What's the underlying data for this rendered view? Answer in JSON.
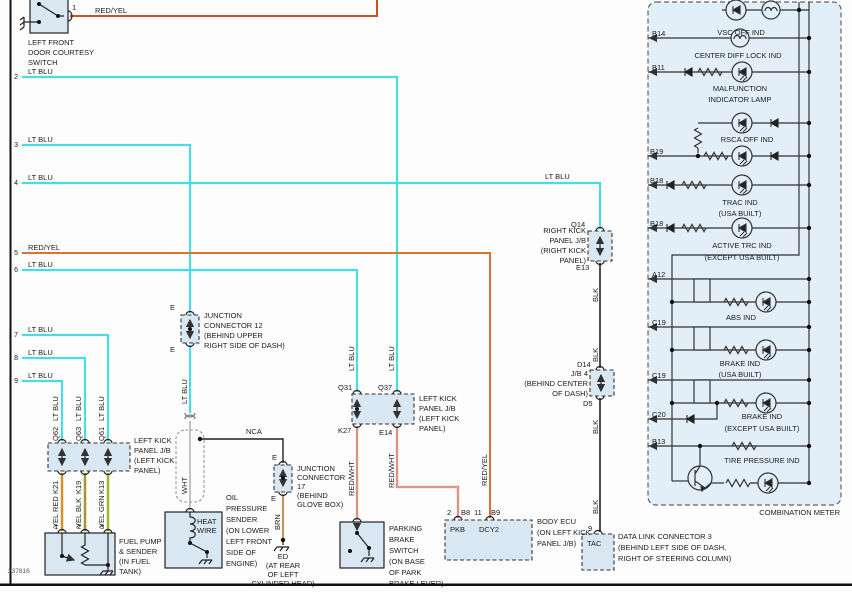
{
  "figure_number": "237816",
  "wire_colors": {
    "lt_blu": "#4ADCE6",
    "red_yel": "#D4512E",
    "red_wht": "#CC5544",
    "yel": "#E4D35C",
    "brn": "#C19A5B",
    "blk": "#3A3A3A",
    "wht": "#C3C3C3"
  },
  "courtesy_switch": {
    "pin": "1",
    "wire_label": "RED/YEL",
    "name_lines": [
      "LEFT FRONT",
      "DOOR COURTESY",
      "SWITCH"
    ]
  },
  "left_lines": [
    {
      "n": "2",
      "label": "LT BLU"
    },
    {
      "n": "3",
      "label": "LT BLU"
    },
    {
      "n": "4",
      "label": "LT BLU",
      "label2": "LT BLU"
    },
    {
      "n": "5",
      "label": "RED/YEL"
    },
    {
      "n": "6",
      "label": "LT BLU"
    },
    {
      "n": "7",
      "label": "LT BLU"
    },
    {
      "n": "8",
      "label": "LT BLU"
    },
    {
      "n": "9",
      "label": "LT BLU"
    }
  ],
  "jb_left_1": {
    "top_pins": [
      "Q62",
      "Q63",
      "Q61"
    ],
    "top_wires": [
      "LT BLU",
      "LT BLU",
      "LT BLU"
    ],
    "bottom_pins": [
      "K21",
      "K19",
      "K13"
    ],
    "bottom_wires": [
      "YEL RED",
      "YEL BLK",
      "YEL GRN"
    ],
    "name_lines": [
      "LEFT KICK",
      "PANEL J/B",
      "(LEFT KICK",
      "PANEL)"
    ]
  },
  "fuel_pump": {
    "pins": [
      "1",
      "2",
      "3"
    ],
    "name_lines": [
      "FUEL PUMP",
      "& SENDER",
      "(IN FUEL",
      "TANK)"
    ]
  },
  "jc12": {
    "pin_top": "E",
    "pin_bottom": "E",
    "wire_below": "LT BLU",
    "name_lines": [
      "JUNCTION",
      "CONNECTOR 12",
      "(BEHIND UPPER",
      "RIGHT SIDE OF DASH)"
    ]
  },
  "shield": {
    "wire": "WHT",
    "nca": "NCA"
  },
  "oil_sender": {
    "inner_lines": [
      "HEAT",
      "WIRE"
    ],
    "name_lines": [
      "OIL",
      "PRESSURE",
      "SENDER",
      "(ON LOWER",
      "LEFT FRONT",
      "SIDE OF",
      "ENGINE)"
    ]
  },
  "jc17": {
    "pin_top": "E",
    "pin_bottom": "E",
    "wire_below": "BRN",
    "name_lines": [
      "JUNCTION",
      "CONNECTOR",
      "17",
      "(BEHIND",
      "GLOVE BOX)"
    ],
    "ground_lines": [
      "ED",
      "(AT REAR",
      "OF LEFT",
      "CYLINDER HEAD)"
    ]
  },
  "jb_left_2": {
    "top_pins": [
      "Q31",
      "Q37"
    ],
    "top_wires": [
      "LT BLU",
      "LT BLU"
    ],
    "bottom_pins": [
      "K27",
      "E14"
    ],
    "bottom_wires": [
      "RED/WHT",
      "RED/WHT"
    ],
    "name_lines": [
      "LEFT KICK",
      "PANEL J/B",
      "(LEFT KICK",
      "PANEL)"
    ]
  },
  "parking_brake": {
    "name_lines": [
      "PARKING",
      "BRAKE",
      "SWITCH",
      "(ON BASE",
      "OF PARK",
      "BRAKE LEVER)"
    ]
  },
  "body_ecu": {
    "pin1_num": "2",
    "pin1_id": "B8",
    "pin1_label": "PKB",
    "pin2_num": "11",
    "pin2_id": "B9",
    "pin2_label": "DCY2",
    "wire": "RED/YEL",
    "name_lines": [
      "BODY ECU",
      "(ON LEFT KICK",
      "PANEL J/B)"
    ]
  },
  "rkp_jb": {
    "pin_top": "Q14",
    "pin_bottom": "E13",
    "blk1": "BLK",
    "blk2": "BLK",
    "name_lines": [
      "RIGHT KICK",
      "PANEL J/B",
      "(RIGHT KICK",
      "PANEL)"
    ]
  },
  "jb4": {
    "pin_top": "D14",
    "pin_bottom": "D5",
    "blk1": "BLK",
    "blk2": "BLK",
    "name_lines": [
      "J/B 4",
      "(BEHIND CENTER",
      "OF DASH)"
    ]
  },
  "dlc3": {
    "pin": "9",
    "inner": "TAC",
    "name_lines": [
      "DATA LINK CONNECTOR 3",
      "(BEHIND LEFT SIDE OF DASH,",
      "RIGHT OF STEERING COLUMN)"
    ]
  },
  "combination_meter": {
    "title": "COMBINATION METER",
    "pins": [
      "B14",
      "B11",
      "B19",
      "B18",
      "B18",
      "A12",
      "C19",
      "C19",
      "C20",
      "B13"
    ],
    "indicators": [
      [
        "VSC OFF IND"
      ],
      [
        "CENTER DIFF LOCK IND"
      ],
      [
        "MALFUNCTION",
        "INDICATOR LAMP"
      ],
      [
        "RSCA OFF IND"
      ],
      [
        "TRAC IND",
        "(USA BUILT)"
      ],
      [
        "ACTIVE TRC IND",
        "(EXCEPT USA BUILT)"
      ],
      [
        "ABS IND"
      ],
      [
        "BRAKE IND",
        "(USA BUILT)"
      ],
      [
        "BRAKE IND",
        "(EXCEPT USA BUILT)"
      ],
      [
        "TIRE PRESSURE IND"
      ]
    ]
  }
}
